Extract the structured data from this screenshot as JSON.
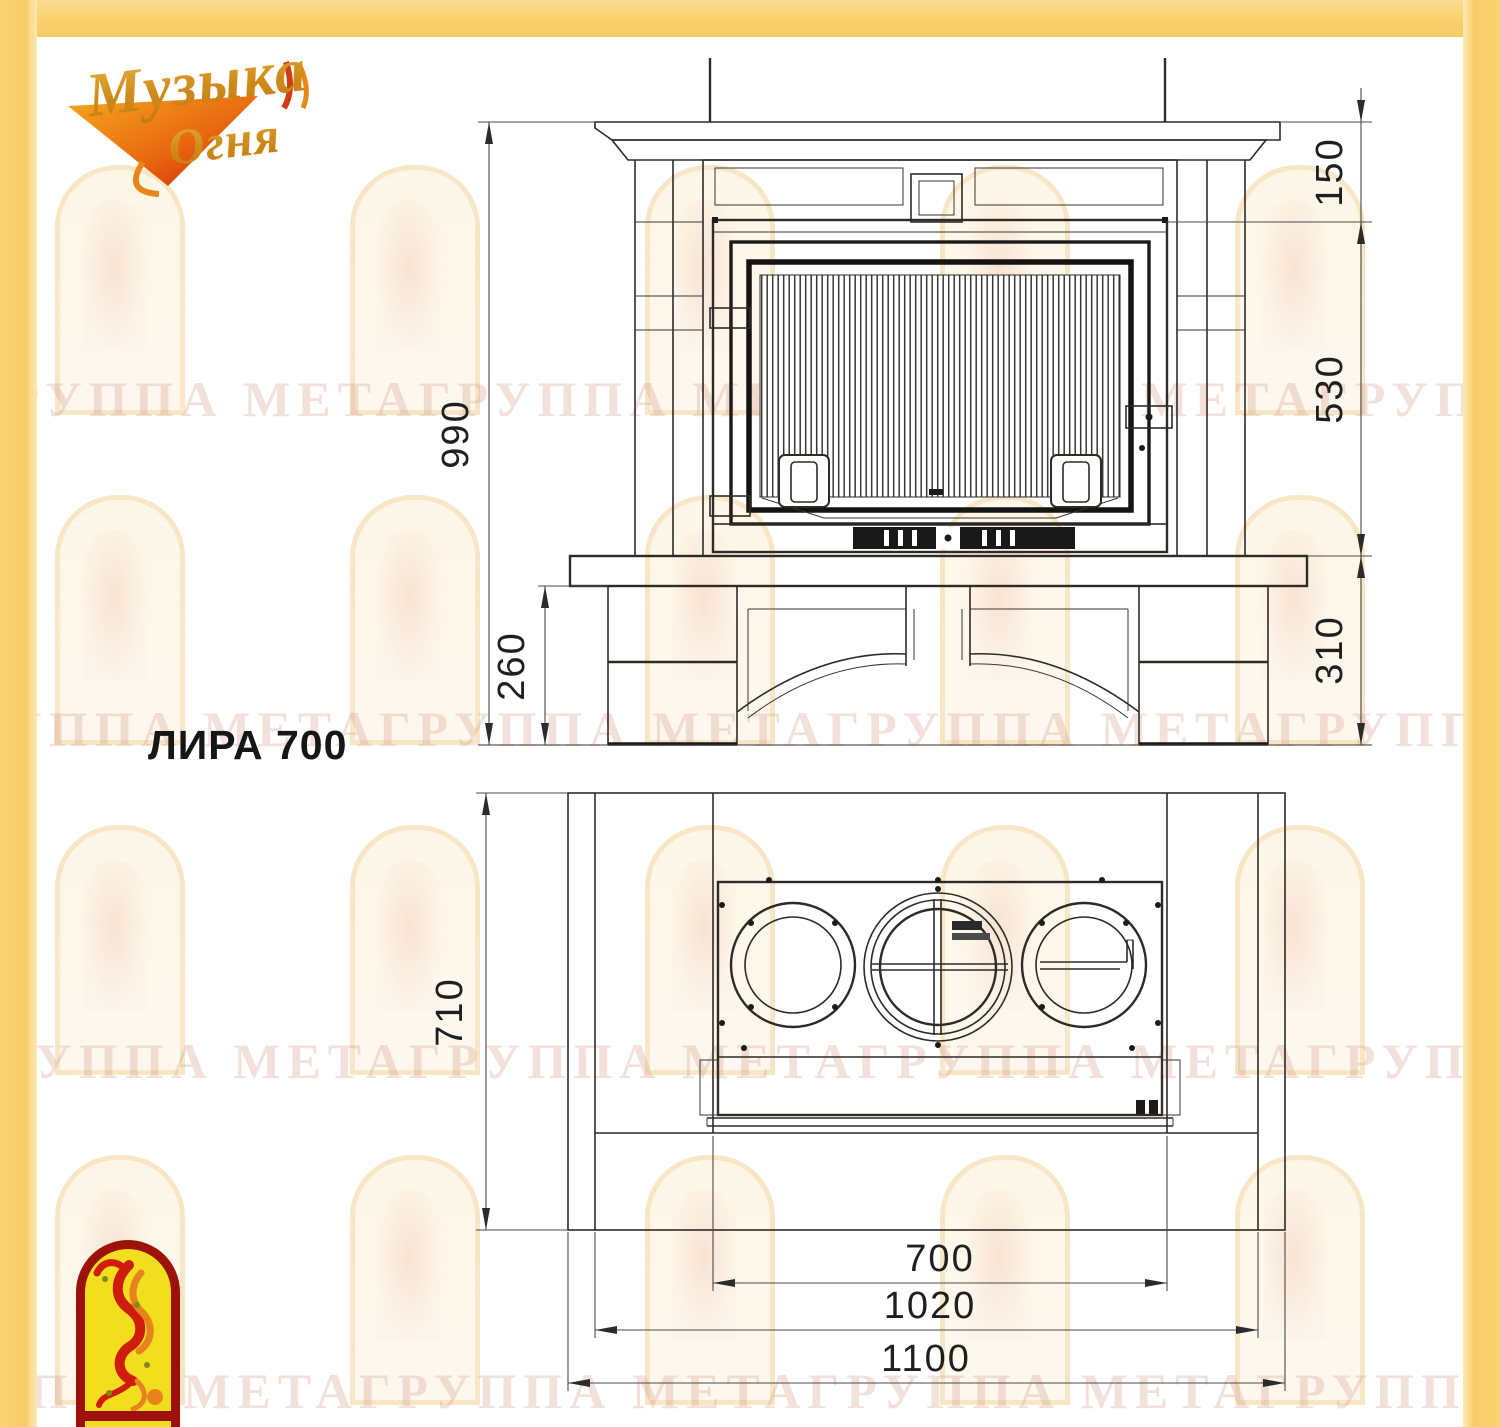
{
  "frame": {
    "color": "#f8cf6d"
  },
  "brand_logo": {
    "line1": "Музыка",
    "line2": "Огня"
  },
  "title": "ЛИРА 700",
  "watermark": {
    "text": "ГРУППА МЕТАГРУППА МЕТАГРУППА МЕТАГРУППА МЕТА"
  },
  "front_view": {
    "label": "front elevation of fireplace",
    "dim_total_height": "990",
    "dim_mantel_to_opening": "150",
    "dim_opening_height": "530",
    "dim_base_height": "310",
    "dim_hearth_clearance": "260"
  },
  "plan_view": {
    "label": "top plan view of fireplace",
    "dim_depth": "710",
    "dim_opening_width": "700",
    "dim_body_width": "1020",
    "dim_overall_width": "1100"
  }
}
